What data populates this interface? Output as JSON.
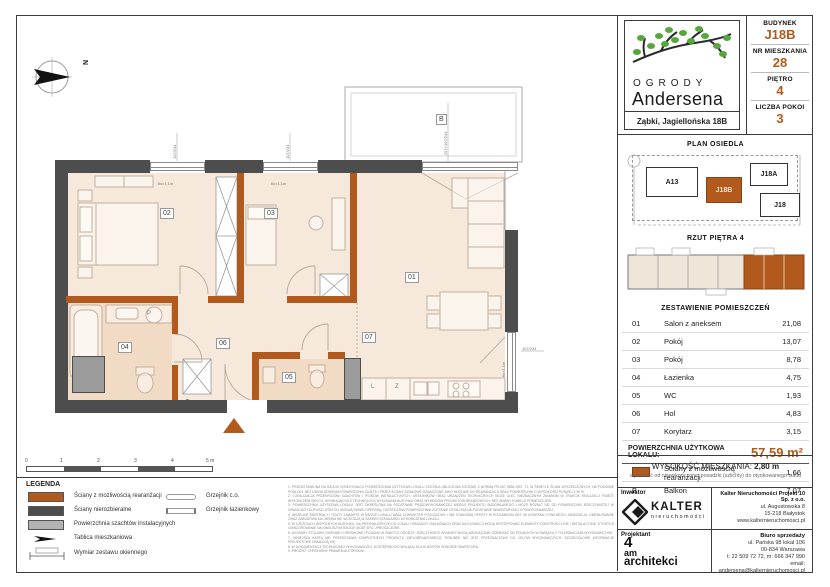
{
  "accent": "#b25a1d",
  "header": {
    "logo_line1": "OGRODY",
    "logo_line2": "Andersena",
    "address": "Ząbki, Jagiellońska 18B",
    "fields": [
      {
        "label": "BUDYNEK",
        "value": "J18B"
      },
      {
        "label": "NR MIESZKANIA",
        "value": "28"
      },
      {
        "label": "PIĘTRO",
        "value": "4"
      },
      {
        "label": "LICZBA POKOI",
        "value": "3"
      }
    ]
  },
  "site_plan": {
    "title": "PLAN OSIEDLA",
    "buildings": [
      {
        "label": "A13"
      },
      {
        "label": "J18B"
      },
      {
        "label": "J18A"
      },
      {
        "label": "J18"
      }
    ]
  },
  "floor_thumb": {
    "title": "RZUT PIĘTRA 4"
  },
  "rooms": {
    "title": "ZESTAWIENIE POMIESZCZEŃ",
    "rows": [
      {
        "no": "01",
        "name": "Salon z aneksem",
        "area": "21,08"
      },
      {
        "no": "02",
        "name": "Pokój",
        "area": "13,07"
      },
      {
        "no": "03",
        "name": "Pokój",
        "area": "8,78"
      },
      {
        "no": "04",
        "name": "Łazienka",
        "area": "4,75"
      },
      {
        "no": "05",
        "name": "WC",
        "area": "1,93"
      },
      {
        "no": "06",
        "name": "Hol",
        "area": "4,83"
      },
      {
        "no": "07",
        "name": "Korytarz",
        "area": "3,15"
      }
    ],
    "total_label": "POWIERZCHNIA UŻYTKOWA LOKALU:",
    "total_value": "57,59 m²",
    "walls_row": {
      "name": "Ściany z możliwością rearanżacji",
      "area": "1,66"
    },
    "balcony_row": {
      "no": "B",
      "name": "Balkon",
      "area": "7,07"
    }
  },
  "plan": {
    "compass_n": "N",
    "labels": {
      "r01": "01",
      "r02": "02",
      "r03": "03",
      "r04": "04",
      "r05": "05",
      "r06": "06",
      "r07": "07",
      "balcony": "B",
      "p": "P",
      "l": "L",
      "z": "Z"
    },
    "dims": {
      "win_top_left": "107/234",
      "win_top_right": "107/234",
      "win_label_left": "fix×1,1m",
      "win_label_right": "fix×1,1m",
      "balcony_door": "257×167/234",
      "right_win_label": "fix×1,1m",
      "right_win_dim": "107/234"
    }
  },
  "scalebar": {
    "ticks": [
      "0",
      "1",
      "2",
      "3",
      "4",
      "5 m"
    ]
  },
  "legend": {
    "title": "LEGENDA",
    "items": [
      {
        "name": "Ściany z możliwością rearanżacji"
      },
      {
        "name": "Ściany nierozbieralne"
      },
      {
        "name": "Powierzchnia szachtów instalacyjnych"
      },
      {
        "name": "Tablica mieszkaniowa"
      },
      {
        "name": "Wymiar zestawu okiennego"
      }
    ],
    "items2": [
      {
        "name": "Grzejnik c.o."
      },
      {
        "name": "Grzejnik łazienkowy"
      }
    ]
  },
  "height_info": {
    "label": "WYSOKOŚĆ MIESZKANIA:",
    "value": "2,80 m",
    "subtitle": "wysokość od niewykończonej posadzki (szlichty) do otynkowanego sufitu"
  },
  "investor": {
    "label": "Inwestor",
    "logo_name": "KALTER",
    "logo_sub": "nieruchomości",
    "company": "Kalter Nieruchomości Projekt 10 Sp. z o.o.",
    "addr1": "ul. Augustowska 8",
    "addr2": "15-218 Białystok",
    "www": "www.kalternieruchomosci.pl"
  },
  "designer": {
    "label": "Projektant",
    "name1": "4",
    "name2": "am",
    "name3": "architekci"
  },
  "sales": {
    "label": "Biuro sprzedaży",
    "addr1": "ul. Pańska 98 lokal 106",
    "addr2": "00-834 Warszawa",
    "phone": "t: 22 509 72 72, m: 666 347 990",
    "email": "email: andersena@kalternieruchomosci.pl"
  },
  "disclaimer": {
    "lines": [
      "1.  PRZEDSTAWIONA NA RZUCIE KONDYGNACJI POWIERZCHNIA UŻYTKOWA LOKALU ZOSTAŁA OBLICZONA ZGODNIE Z NORMĄ PN-ISO 9836:1997, TJ. W ŚWIETLE ŚCIAN WYKOŃCZONYCH, NA POZIOMIE PODŁOGI, BEZ UWZGLĘDNIENIA POWIERZCHNI ZAJĘTEJ PRZEZ ŚCIANY DZIAŁOWE OZNACZONE JAKO MOŻLIWE DO REARANŻACJI ORAZ POWIERZCHNI O WYSOKOŚCI PONIŻEJ 1,90 M.",
      "2.  LOKALIZACJA PRZEKROJÓW SZACHTÓW I PIONÓW INSTALACYJNYCH, GRZEJNIKÓW ORAZ URZĄDZEŃ TECHNICZNYCH MOŻE ULEC NIEZNACZNYM ZMIANOM W TRAKCIE REALIZACJI ROBÓT WYKOŃCZENIOWYCH, WYNIKAJĄCYM Z TECHNOLOGII WYKONANIA BUDYNKU ORAZ WYMOGÓW PROJEKTÓW BRANŻOWYCH, BEZ ZMIANY FUNKCJI POMIESZCZEŃ.",
      "3.  POWIERZCHNIA UŻYTKOWA LOKALU JEST OKREŚLONA NA PODSTAWIE PRZEDWYKONAWCZEJ WERSJI PROJEKTU BUDOWLANEGO I MOŻE RÓŻNIĆ SIĘ OD POWIERZCHNI RZECZYWISTEJ W GRANICACH DOPUSZCZONYCH UMOWĄ DEWELOPERSKĄ; OSTATECZNA POWIERZCHNIA ZOSTANIE USTALONA NA PODSTAWIE INWENTARYZACJI POWYKONAWCZEJ.",
      "4.  WSZELKIE MATERIAŁY I RZUTY ZAWARTE W KARCIE LOKALU MAJĄ CHARAKTER POGLĄDOWY I NIE STANOWIĄ OFERTY W ROZUMIENIU ART. 66 KODEKSU CYWILNEGO; ARANŻACJA, UMEBLOWANIE ORAZ ZABUDOWA KUCHENNA NIE WCHODZĄ W ZAKRES STANDARDU WYKOŃCZENIA LOKALU.",
      "5.  W CZĘŚCIACH WSPÓLNYCH BUDYNKU, NA PRZYNALEŻNYCH DO LOKALI TARASACH I BALKONACH ORAZ NA ELEWACJI MOGĄ WYSTĘPOWAĆ ELEMENTY KONSTRUKCYJNE I INSTALACYJNE, KTÓRYCH ODWZOROWANIE NA NINIEJSZYM RZUCIE MOŻE BYĆ UPROSZCZONE.",
      "6.  WYMIARY STOLARKI OKIENNEJ I DRZWIOWEJ PODANO W ŚWIETLE OŚCIEŻY; RZECZYWISTE WYMIARY MOGĄ NIEZNACZNIE ODBIEGAĆ OD PODANYCH W ZWIĄZKU Z TOLERANCJAMI WYKONAWCZYMI.",
      "7.  NINIEJSZA KARTA NIE PRZEDSTAWIA KOMPLETNEGO PROJEKTU WIELOBRANŻOWEGO; RYSUNEK NIE JEST PRZEZNACZONY DO CELÓW WYKONAWCZYCH. SZCZEGÓŁOWE INFORMACJE PROJEKTOWE ZNAJDUJĄ SIĘ",
      "8.  W DOKUMENTACJI TECHNICZNEJ WYKONAWCZEJ, DOSTĘPNEJ DO WGLĄDU DLA KLIENTÓW W BIURZE INWESTORA.",
      "9.  PROJEKT CHRONIONY PRAWEM AUTORSKIM."
    ]
  }
}
